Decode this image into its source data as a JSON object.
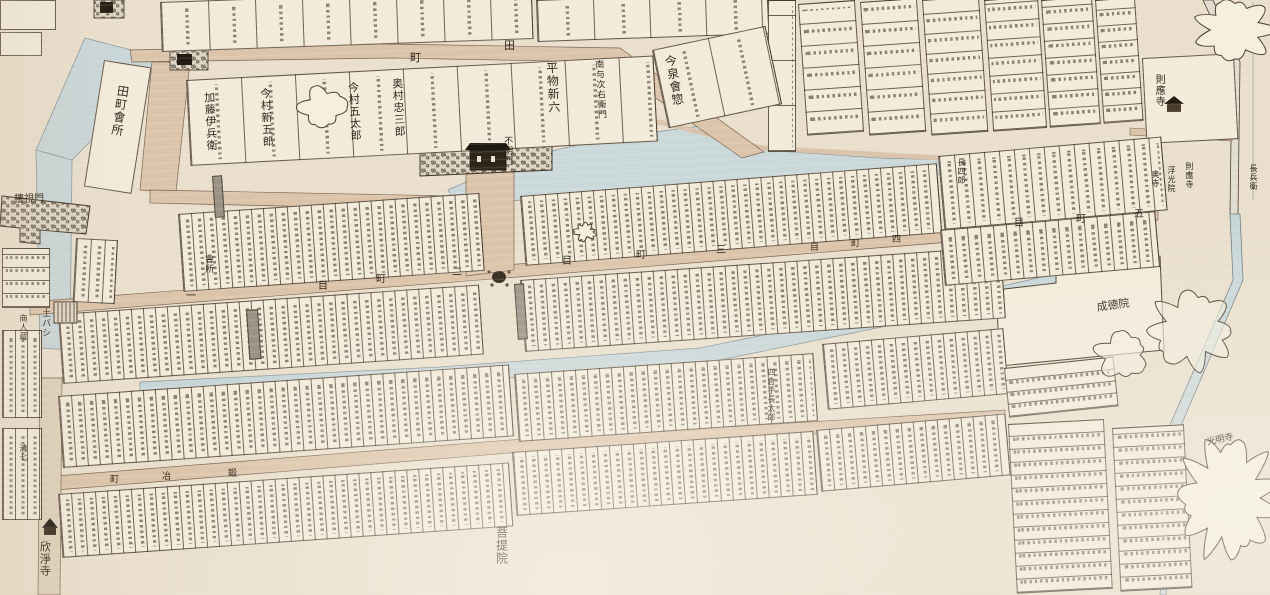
{
  "map": {
    "type": "historical-japanese-cadastral-town-map",
    "palette": {
      "paper": "#e9dfcc",
      "parcel": "#f2ebda",
      "street": "#dcc4aa",
      "water": "#c9d6d8",
      "ink": "#2e2418",
      "stone": "#8d8578",
      "lane_gray": "#9a9285"
    },
    "streets": [
      "田町",
      "一町目",
      "二町目",
      "三町目",
      "四町目",
      "五町目",
      "鍛冶町"
    ],
    "landmarks": [
      "不明門",
      "樓視門",
      "田町會所",
      "會所",
      "土バシ",
      "商人蔵",
      "欣淨寺",
      "則應寺",
      "浮光院",
      "奥寺",
      "成德院",
      "菩提院",
      "光明寺"
    ],
    "parcel_names": [
      "加藤伊兵衛",
      "今村新五郎",
      "今村五太郎",
      "奥村忠三郎",
      "平物新六",
      "南与次右衛門",
      "今泉會惣",
      "長四郎",
      "長兵衛",
      "四倉手長太郎",
      "清七"
    ],
    "labels": [
      {
        "t": "田町會所",
        "x": 116,
        "y": 84,
        "s": 12,
        "v": 1,
        "r": 8
      },
      {
        "t": "加藤伊兵衛",
        "x": 202,
        "y": 92,
        "s": 11,
        "v": 1,
        "r": -3
      },
      {
        "t": "今村新五郎",
        "x": 258,
        "y": 88,
        "s": 11,
        "v": 1,
        "r": -3
      },
      {
        "t": "今村五太郎",
        "x": 346,
        "y": 82,
        "s": 11,
        "v": 1,
        "r": -3
      },
      {
        "t": "奥村忠三郎",
        "x": 390,
        "y": 78,
        "s": 11,
        "v": 1,
        "r": -3
      },
      {
        "t": "平物新六",
        "x": 544,
        "y": 62,
        "s": 12,
        "v": 1,
        "r": -3
      },
      {
        "t": "南与次右衛門",
        "x": 593,
        "y": 60,
        "s": 9,
        "v": 1,
        "r": -3
      },
      {
        "t": "今泉會惣",
        "x": 662,
        "y": 56,
        "s": 12,
        "v": 1,
        "r": -10
      },
      {
        "t": "田",
        "x": 504,
        "y": 40,
        "s": 11
      },
      {
        "t": "町",
        "x": 410,
        "y": 52,
        "s": 11
      },
      {
        "t": "不明門",
        "x": 502,
        "y": 136,
        "s": 9,
        "v": 1
      },
      {
        "t": "樓視門",
        "x": 14,
        "y": 194,
        "s": 10
      },
      {
        "t": "會所",
        "x": 203,
        "y": 254,
        "s": 9,
        "v": 1
      },
      {
        "t": "一",
        "x": 186,
        "y": 291,
        "s": 10
      },
      {
        "t": "目",
        "x": 318,
        "y": 281,
        "s": 10
      },
      {
        "t": "町",
        "x": 376,
        "y": 274,
        "s": 10
      },
      {
        "t": "二",
        "x": 452,
        "y": 267,
        "s": 10
      },
      {
        "t": "目",
        "x": 562,
        "y": 256,
        "s": 10
      },
      {
        "t": "町",
        "x": 636,
        "y": 250,
        "s": 10
      },
      {
        "t": "三",
        "x": 716,
        "y": 245,
        "s": 10
      },
      {
        "t": "目",
        "x": 810,
        "y": 243,
        "s": 9
      },
      {
        "t": "町",
        "x": 851,
        "y": 239,
        "s": 9
      },
      {
        "t": "四",
        "x": 892,
        "y": 235,
        "s": 9
      },
      {
        "t": "目",
        "x": 1014,
        "y": 218,
        "s": 10
      },
      {
        "t": "町",
        "x": 1076,
        "y": 214,
        "s": 10
      },
      {
        "t": "五",
        "x": 1134,
        "y": 209,
        "s": 10
      },
      {
        "t": "町",
        "x": 110,
        "y": 475,
        "s": 9
      },
      {
        "t": "冶",
        "x": 162,
        "y": 472,
        "s": 9
      },
      {
        "t": "鍛",
        "x": 228,
        "y": 469,
        "s": 9
      },
      {
        "t": "土バシ",
        "x": 40,
        "y": 308,
        "s": 9,
        "v": 1
      },
      {
        "t": "商人蔵",
        "x": 18,
        "y": 314,
        "s": 8,
        "v": 1
      },
      {
        "t": "清七",
        "x": 18,
        "y": 444,
        "s": 8,
        "v": 1
      },
      {
        "t": "欣淨寺",
        "x": 38,
        "y": 541,
        "s": 11,
        "v": 1
      },
      {
        "t": "菩提院",
        "x": 494,
        "y": 526,
        "s": 12,
        "v": 1
      },
      {
        "t": "則應寺",
        "x": 1153,
        "y": 74,
        "s": 10,
        "v": 1
      },
      {
        "t": "奥寺",
        "x": 1150,
        "y": 170,
        "s": 8,
        "v": 1
      },
      {
        "t": "浮光院",
        "x": 1166,
        "y": 166,
        "s": 8,
        "v": 1
      },
      {
        "t": "則應寺",
        "x": 1184,
        "y": 162,
        "s": 8,
        "v": 1
      },
      {
        "t": "長四郎",
        "x": 956,
        "y": 158,
        "s": 8,
        "v": 1
      },
      {
        "t": "長兵衛",
        "x": 1248,
        "y": 164,
        "s": 8,
        "v": 1
      },
      {
        "t": "四倉手長太郎",
        "x": 766,
        "y": 368,
        "s": 8,
        "v": 1
      },
      {
        "t": "成德院",
        "x": 1096,
        "y": 302,
        "s": 11,
        "r": -8
      },
      {
        "t": "光明寺",
        "x": 1206,
        "y": 438,
        "s": 9,
        "r": -12
      }
    ],
    "blocks": [
      {
        "x": 0,
        "y": 0,
        "w": 56,
        "h": 30,
        "r": 0
      },
      {
        "x": 0,
        "y": 32,
        "w": 42,
        "h": 24,
        "r": 0
      },
      {
        "x": 160,
        "y": 2,
        "w": 372,
        "h": 50,
        "r": -2,
        "sp": 47,
        "dir": "v",
        "ink": "v"
      },
      {
        "x": 536,
        "y": 0,
        "w": 232,
        "h": 42,
        "r": -2,
        "sp": 56,
        "dir": "v",
        "ink": "v"
      },
      {
        "x": 768,
        "y": 0,
        "w": 28,
        "h": 152,
        "r": 0,
        "sp": 45,
        "dir": "h",
        "ink": "v"
      },
      {
        "x": 798,
        "y": 4,
        "w": 57,
        "h": 132,
        "r": -4,
        "sp": 22,
        "dir": "h",
        "ink": "h"
      },
      {
        "x": 860,
        "y": 2,
        "w": 57,
        "h": 134,
        "r": -4,
        "sp": 22,
        "dir": "h",
        "ink": "h"
      },
      {
        "x": 922,
        "y": 0,
        "w": 57,
        "h": 136,
        "r": -4,
        "sp": 20,
        "dir": "h",
        "ink": "h"
      },
      {
        "x": 984,
        "y": 0,
        "w": 54,
        "h": 132,
        "r": -4,
        "sp": 18,
        "dir": "h",
        "ink": "h"
      },
      {
        "x": 1041,
        "y": 0,
        "w": 51,
        "h": 128,
        "r": -4,
        "sp": 17,
        "dir": "h",
        "ink": "h"
      },
      {
        "x": 1095,
        "y": 0,
        "w": 40,
        "h": 124,
        "r": -4,
        "sp": 16,
        "dir": "h",
        "ink": "h"
      },
      {
        "x": 1142,
        "y": 58,
        "w": 92,
        "h": 86,
        "r": -3
      },
      {
        "x": 104,
        "y": 60,
        "w": 48,
        "h": 128,
        "r": 9
      },
      {
        "x": 186,
        "y": 80,
        "w": 468,
        "h": 86,
        "r": -3,
        "sp": 54,
        "dir": "v",
        "ink": "v"
      },
      {
        "x": 652,
        "y": 50,
        "w": 116,
        "h": 80,
        "r": -12,
        "sp": 56,
        "dir": "v",
        "ink": "v"
      },
      {
        "x": 178,
        "y": 214,
        "w": 302,
        "h": 78,
        "r": -4,
        "sp": 12,
        "dir": "v",
        "ink": "v"
      },
      {
        "x": 520,
        "y": 196,
        "w": 418,
        "h": 70,
        "r": -4.5,
        "sp": 12,
        "dir": "v",
        "ink": "v"
      },
      {
        "x": 938,
        "y": 156,
        "w": 224,
        "h": 74,
        "r": -5,
        "sp": 15,
        "dir": "v",
        "ink": "v"
      },
      {
        "x": 58,
        "y": 314,
        "w": 422,
        "h": 70,
        "r": -4,
        "sp": 12,
        "dir": "v",
        "ink": "v"
      },
      {
        "x": 520,
        "y": 280,
        "w": 482,
        "h": 72,
        "r": -4,
        "sp": 12,
        "dir": "v",
        "ink": "v"
      },
      {
        "x": 940,
        "y": 230,
        "w": 216,
        "h": 56,
        "r": -5,
        "sp": 13,
        "dir": "v",
        "ink": "v"
      },
      {
        "x": 58,
        "y": 396,
        "w": 452,
        "h": 72,
        "r": -4,
        "sp": 12,
        "dir": "v",
        "ink": "v"
      },
      {
        "x": 514,
        "y": 374,
        "w": 300,
        "h": 68,
        "r": -4,
        "sp": 12,
        "dir": "v",
        "ink": "v"
      },
      {
        "x": 822,
        "y": 344,
        "w": 182,
        "h": 66,
        "r": -5,
        "sp": 12,
        "dir": "v",
        "ink": "v"
      },
      {
        "x": 58,
        "y": 494,
        "w": 452,
        "h": 64,
        "r": -4,
        "sp": 12,
        "dir": "v",
        "ink": "v"
      },
      {
        "x": 512,
        "y": 452,
        "w": 302,
        "h": 64,
        "r": -4,
        "sp": 12,
        "dir": "v",
        "ink": "v"
      },
      {
        "x": 816,
        "y": 430,
        "w": 190,
        "h": 62,
        "r": -5,
        "sp": 12,
        "dir": "v",
        "ink": "v"
      },
      {
        "x": 2,
        "y": 248,
        "w": 48,
        "h": 60,
        "r": 0,
        "sp": 13,
        "dir": "h",
        "ink": "h"
      },
      {
        "x": 2,
        "y": 330,
        "w": 40,
        "h": 88,
        "r": 0,
        "sp": 12,
        "dir": "v",
        "ink": "v"
      },
      {
        "x": 2,
        "y": 428,
        "w": 40,
        "h": 92,
        "r": 0,
        "sp": 12,
        "dir": "v",
        "ink": "v"
      },
      {
        "x": 76,
        "y": 238,
        "w": 42,
        "h": 64,
        "r": 3,
        "sp": 14,
        "dir": "v",
        "ink": "v"
      },
      {
        "x": 1008,
        "y": 424,
        "w": 96,
        "h": 170,
        "r": -3,
        "sp": 13,
        "dir": "h",
        "ink": "h"
      },
      {
        "x": 1112,
        "y": 428,
        "w": 72,
        "h": 164,
        "r": -3,
        "sp": 13,
        "dir": "h",
        "ink": "h"
      },
      {
        "x": 1004,
        "y": 368,
        "w": 110,
        "h": 50,
        "r": -6,
        "sp": 12,
        "dir": "h",
        "ink": "h"
      },
      {
        "x": 212,
        "y": 176,
        "w": 10,
        "h": 42,
        "r": -4,
        "f": "#9a9285",
        "lane": 1
      },
      {
        "x": 246,
        "y": 310,
        "w": 12,
        "h": 50,
        "r": -4,
        "f": "#9a9285",
        "lane": 1
      },
      {
        "x": 514,
        "y": 284,
        "w": 10,
        "h": 56,
        "r": -4,
        "f": "#9a9285",
        "lane": 1
      }
    ],
    "trees": [
      {
        "cx": 322,
        "cy": 107,
        "rx": 26,
        "ry": 22,
        "o": 1
      },
      {
        "cx": 1235,
        "cy": 30,
        "rx": 44,
        "ry": 34,
        "o": 1
      },
      {
        "cx": 1192,
        "cy": 330,
        "rx": 48,
        "ry": 44,
        "o": 0.6
      },
      {
        "cx": 1122,
        "cy": 355,
        "rx": 30,
        "ry": 26,
        "o": 0.6
      },
      {
        "cx": 1228,
        "cy": 498,
        "rx": 56,
        "ry": 68,
        "o": 1
      },
      {
        "cx": 585,
        "cy": 232,
        "rx": 11,
        "ry": 8,
        "o": 1
      }
    ],
    "icons": [
      "castle-gate-wall",
      "gatehouse",
      "well",
      "earth-bridge",
      "temple-gate-kinjoji",
      "temple-building-sokuoji",
      "stone-wall-west-gate"
    ]
  }
}
